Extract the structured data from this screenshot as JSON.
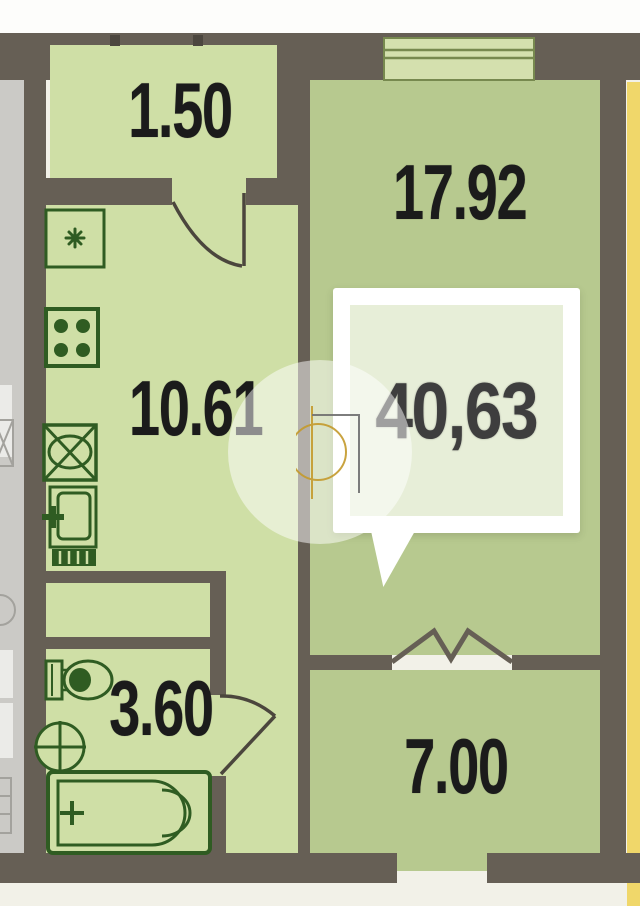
{
  "floorplan": {
    "title": "apartment-floor-plan",
    "rooms": {
      "entry": {
        "name": "entry-hall",
        "area": "1.50"
      },
      "living_room": {
        "name": "living-room",
        "area": "17.92"
      },
      "kitchen": {
        "name": "kitchen",
        "area": "10.61"
      },
      "bathroom": {
        "name": "bathroom",
        "area": "3.60"
      },
      "balcony": {
        "name": "balcony",
        "area": "7.00"
      }
    },
    "total_area_callout": {
      "value": "40,63"
    },
    "colors": {
      "wall": "#665f55",
      "room_fill": "#b7c98f",
      "secondary_fill": "#cfdfa6",
      "window_fill": "#d4e0ae",
      "fixture_stroke": "#2f5c22",
      "door_stroke": "#4b463d",
      "neighbor_yellow": "#f0d76a",
      "neighbor_gray": "#cbcac6",
      "background": "#f2f1e8",
      "callout_fill": "#e7eed8",
      "watermark_gold": "#c49a2c",
      "label_color": "#1b1b1b",
      "callout_text_color": "#3e3e3e"
    },
    "icons": [
      "vent-icon",
      "stove-icon",
      "kitchen-sink-icon",
      "counter-appliance-icon",
      "toilet-icon",
      "washbasin-icon",
      "bathtub-icon",
      "door-swing-icon",
      "balcony-door-icon",
      "window-icon",
      "watermark-logo-icon"
    ]
  }
}
